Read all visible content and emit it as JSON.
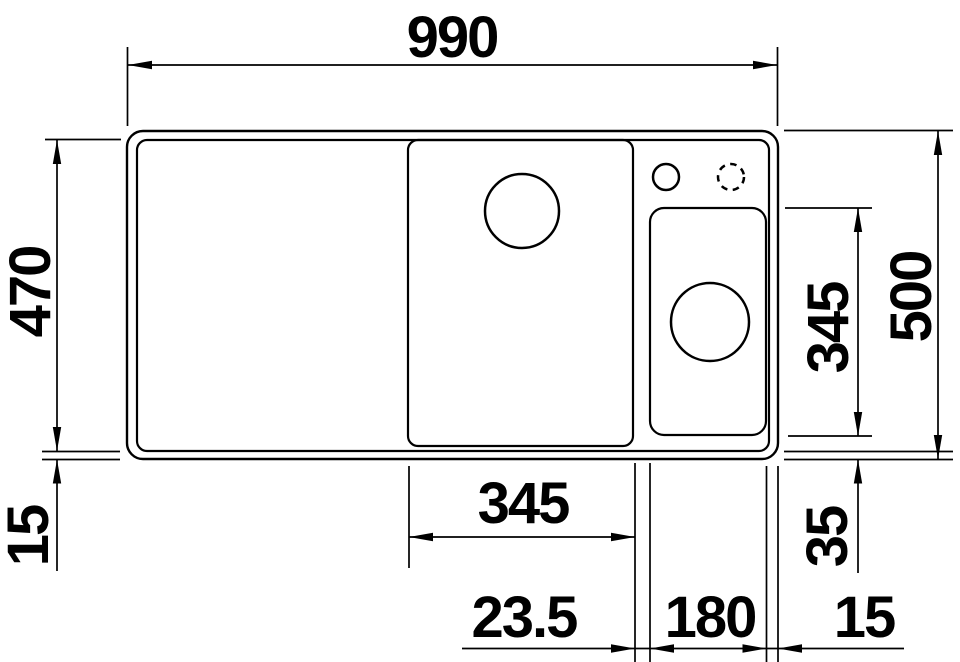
{
  "colors": {
    "line": "#000000",
    "background": "#ffffff"
  },
  "dimensions": {
    "overall_width": "990",
    "inner_depth": "470",
    "overall_depth": "500",
    "main_bowl_width": "345",
    "side_bowl_depth": "345",
    "rim_offset_left": "15",
    "side_bowl_offset": "35",
    "bowl_gap": "23.5",
    "side_bowl_width": "180",
    "rim_offset_right": "15"
  }
}
